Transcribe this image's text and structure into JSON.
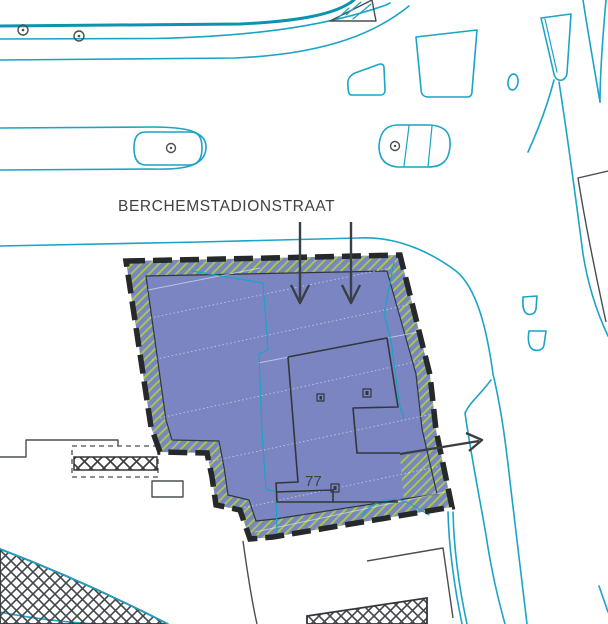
{
  "map": {
    "street_label": "BERCHEMSTADIONSTRAAT",
    "parcel_number": "77",
    "annotations": {
      "entrance_arrows_down": 2,
      "exit_arrow_right": 1
    },
    "colors": {
      "parcel_fill": "#7a85c2",
      "hatch_green": "#a3c84b",
      "street_cyan": "#1ba4c6",
      "street_teal": "#0d93ae",
      "line_dark": "#33373b",
      "border_dark": "#26282b",
      "line_gray": "#4a4e52",
      "arrow_dark": "#3a3f44",
      "label_dark": "#3f4245",
      "faint_line": "rgba(255,255,255,0.5)"
    }
  }
}
